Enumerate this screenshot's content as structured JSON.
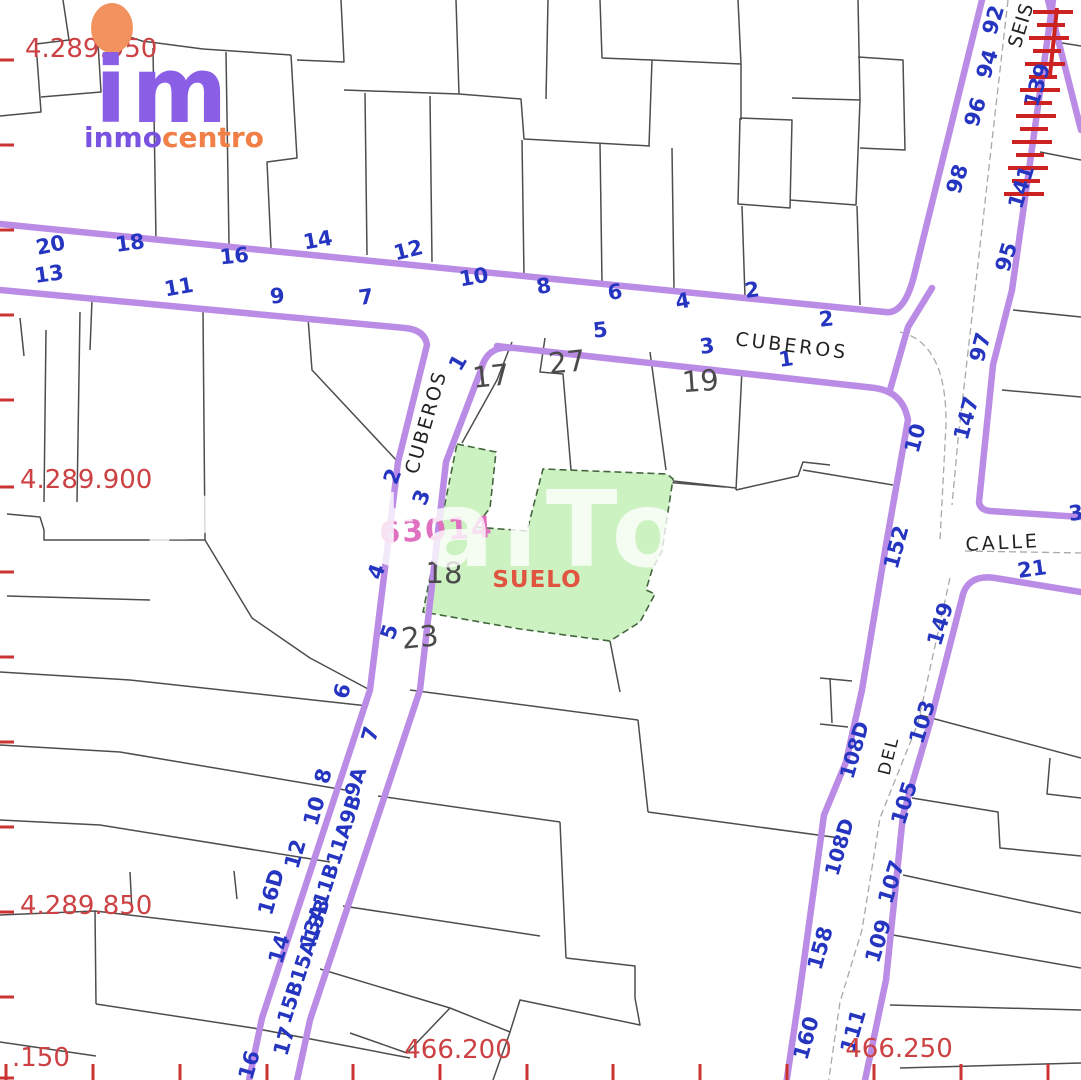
{
  "canvas": {
    "width": 1081,
    "height": 1080,
    "background": "#ffffff"
  },
  "colors": {
    "street_edge": "#bb8ce6",
    "parcel_line": "#4d4d4d",
    "house_number_blue": "#2535c0",
    "coordinate_red": "#cc4143",
    "suelo_green_fill": "#cdf2c2",
    "suelo_green_border": "#44663f",
    "block_number_pink": "#e070c0",
    "watermark_white": "#ffffff",
    "railway_hatch_red": "#cc2222",
    "logo_purple": "#8a5fe6",
    "logo_orange": "#f08048"
  },
  "logo": {
    "mark": "im",
    "name_primary": "inmo",
    "name_secondary": "centro"
  },
  "watermark": {
    "text": "PortalTo"
  },
  "land_parcel": {
    "label": "SUELO",
    "block_number": "63014",
    "parcel_number": "18"
  },
  "map_labels": {
    "house_numbers_blue": [
      {
        "t": "20",
        "x": 52,
        "y": 252,
        "r": -12
      },
      {
        "t": "18",
        "x": 131,
        "y": 250,
        "r": -8
      },
      {
        "t": "16",
        "x": 235,
        "y": 263,
        "r": -6
      },
      {
        "t": "14",
        "x": 319,
        "y": 247,
        "r": -10
      },
      {
        "t": "12",
        "x": 410,
        "y": 257,
        "r": -14
      },
      {
        "t": "10",
        "x": 475,
        "y": 284,
        "r": -10
      },
      {
        "t": "8",
        "x": 545,
        "y": 293,
        "r": -10
      },
      {
        "t": "6",
        "x": 616,
        "y": 299,
        "r": -8
      },
      {
        "t": "4",
        "x": 684,
        "y": 308,
        "r": -10
      },
      {
        "t": "2",
        "x": 753,
        "y": 297,
        "r": -8
      },
      {
        "t": "13",
        "x": 50,
        "y": 281,
        "r": -8
      },
      {
        "t": "11",
        "x": 180,
        "y": 294,
        "r": -10
      },
      {
        "t": "9",
        "x": 278,
        "y": 303,
        "r": -6
      },
      {
        "t": "7",
        "x": 367,
        "y": 304,
        "r": -8
      },
      {
        "t": "5",
        "x": 601,
        "y": 337,
        "r": -6
      },
      {
        "t": "3",
        "x": 708,
        "y": 353,
        "r": -8
      },
      {
        "t": "1",
        "x": 787,
        "y": 366,
        "r": -8
      },
      {
        "t": "2",
        "x": 827,
        "y": 326,
        "r": -6
      },
      {
        "t": "1",
        "x": 464,
        "y": 366,
        "r": -60
      },
      {
        "t": "2",
        "x": 399,
        "y": 479,
        "r": -68
      },
      {
        "t": "3",
        "x": 428,
        "y": 500,
        "r": -68
      },
      {
        "t": "4",
        "x": 383,
        "y": 574,
        "r": -70
      },
      {
        "t": "5",
        "x": 396,
        "y": 634,
        "r": -72
      },
      {
        "t": "6",
        "x": 349,
        "y": 693,
        "r": -74
      },
      {
        "t": "7",
        "x": 377,
        "y": 736,
        "r": -74
      },
      {
        "t": "8",
        "x": 330,
        "y": 778,
        "r": -74
      },
      {
        "t": "10",
        "x": 321,
        "y": 813,
        "r": -74
      },
      {
        "t": "12",
        "x": 302,
        "y": 856,
        "r": -74
      },
      {
        "t": "16D",
        "x": 278,
        "y": 894,
        "r": -74
      },
      {
        "t": "14",
        "x": 286,
        "y": 951,
        "r": -74
      },
      {
        "t": "17",
        "x": 291,
        "y": 1043,
        "r": -74
      },
      {
        "t": "16",
        "x": 256,
        "y": 1067,
        "r": -74
      },
      {
        "t": "9A",
        "x": 362,
        "y": 784,
        "r": -72,
        "s": 20
      },
      {
        "t": "13A11B11A9B",
        "x": 337,
        "y": 873,
        "r": -72,
        "s": 20
      },
      {
        "t": "15B15A13B",
        "x": 310,
        "y": 963,
        "r": -72,
        "s": 20
      },
      {
        "t": "92",
        "x": 1000,
        "y": 22,
        "r": -73
      },
      {
        "t": "94",
        "x": 994,
        "y": 66,
        "r": -73
      },
      {
        "t": "96",
        "x": 982,
        "y": 114,
        "r": -73
      },
      {
        "t": "98",
        "x": 964,
        "y": 181,
        "r": -73
      },
      {
        "t": "139",
        "x": 1044,
        "y": 87,
        "r": -73
      },
      {
        "t": "141",
        "x": 1028,
        "y": 189,
        "r": -73
      },
      {
        "t": "95",
        "x": 1013,
        "y": 259,
        "r": -73
      },
      {
        "t": "97",
        "x": 987,
        "y": 349,
        "r": -75
      },
      {
        "t": "147",
        "x": 973,
        "y": 420,
        "r": -75
      },
      {
        "t": "10",
        "x": 922,
        "y": 440,
        "r": -75
      },
      {
        "t": "152",
        "x": 903,
        "y": 549,
        "r": -75
      },
      {
        "t": "21",
        "x": 1033,
        "y": 576,
        "r": -8
      },
      {
        "t": "3",
        "x": 1077,
        "y": 520,
        "r": -8
      },
      {
        "t": "149",
        "x": 947,
        "y": 626,
        "r": -73
      },
      {
        "t": "103",
        "x": 929,
        "y": 724,
        "r": -73
      },
      {
        "t": "105",
        "x": 911,
        "y": 805,
        "r": -73
      },
      {
        "t": "107",
        "x": 898,
        "y": 884,
        "r": -73
      },
      {
        "t": "109",
        "x": 885,
        "y": 943,
        "r": -73
      },
      {
        "t": "108D",
        "x": 861,
        "y": 752,
        "r": -74,
        "s": 20
      },
      {
        "t": "108D",
        "x": 846,
        "y": 849,
        "r": -74,
        "s": 20
      },
      {
        "t": "158",
        "x": 827,
        "y": 950,
        "r": -74
      },
      {
        "t": "160",
        "x": 813,
        "y": 1040,
        "r": -74
      },
      {
        "t": "111",
        "x": 860,
        "y": 1033,
        "r": -74
      }
    ],
    "parcel_numbers_black": [
      {
        "t": "17",
        "x": 492,
        "y": 386,
        "r": -6
      },
      {
        "t": "27",
        "x": 568,
        "y": 372,
        "r": -6
      },
      {
        "t": "19",
        "x": 701,
        "y": 391,
        "r": -4
      },
      {
        "t": "18",
        "x": 444,
        "y": 583
      },
      {
        "t": "23",
        "x": 421,
        "y": 647,
        "r": -6
      }
    ],
    "block_numbers_pink": [
      {
        "t": "63014",
        "x": 437,
        "y": 540,
        "r": -3,
        "s": 30,
        "ls": 2
      }
    ],
    "street_names": [
      {
        "t": "CUBEROS",
        "x": 791,
        "y": 352,
        "r": 7,
        "ls": 3
      },
      {
        "t": "CUBEROS",
        "x": 432,
        "y": 424,
        "r": -74,
        "ls": 2
      },
      {
        "t": "SEIS",
        "x": 1027,
        "y": 27,
        "r": -73,
        "ls": 1
      },
      {
        "t": "CALLE",
        "x": 1003,
        "y": 549,
        "r": -3,
        "ls": 3
      },
      {
        "t": "DEL",
        "x": 894,
        "y": 757,
        "r": -76,
        "ls": 2,
        "s": 17
      }
    ],
    "coordinate_labels_red": [
      {
        "t": "4.289.950",
        "x": 25,
        "y": 57,
        "a": "start"
      },
      {
        "t": "4.289.900",
        "x": 20,
        "y": 488,
        "a": "start"
      },
      {
        "t": "4.289.850",
        "x": 20,
        "y": 914,
        "a": "start"
      },
      {
        "t": ".150",
        "x": 12,
        "y": 1066,
        "a": "start"
      },
      {
        "t": "466.200",
        "x": 458,
        "y": 1058
      },
      {
        "t": "466.250",
        "x": 899,
        "y": 1057
      }
    ],
    "land_labels": [
      {
        "t": "SUELO",
        "x": 537,
        "y": 587,
        "s": 23,
        "ls": 1
      }
    ]
  },
  "ticks": {
    "left_y": [
      60,
      145,
      230,
      315,
      400,
      487,
      572,
      657,
      742,
      827,
      912,
      997,
      1078
    ],
    "bottom_x": [
      6,
      93,
      180,
      267,
      353,
      440,
      527,
      613,
      700,
      787,
      874,
      961,
      1048
    ]
  },
  "symbols": {
    "railway_hatch": "red-hatch-marks",
    "logo_dot": "orange-blob"
  }
}
